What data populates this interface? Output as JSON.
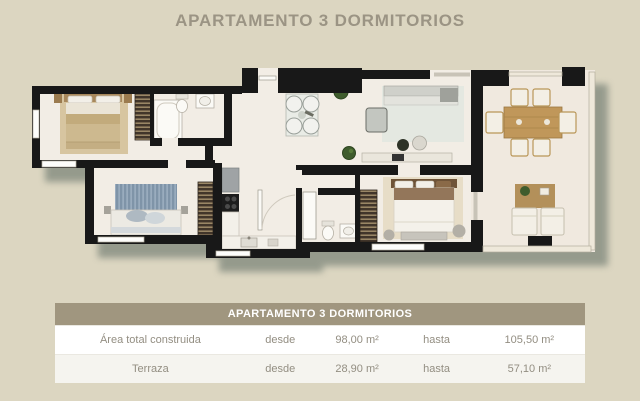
{
  "title": "APARTAMENTO 3 DORMITORIOS",
  "table": {
    "header": "APARTAMENTO 3 DORMITORIOS",
    "rows": [
      {
        "cells": [
          "Área total construida",
          "desde",
          "98,00 m²",
          "hasta",
          "105,50 m²"
        ]
      },
      {
        "cells": [
          "Terraza",
          "desde",
          "28,90 m²",
          "hasta",
          "57,10 m²"
        ]
      }
    ]
  },
  "colors": {
    "page_background": "#dcd6c1",
    "title_text": "#9b9484",
    "table_header_background": "#a0967f",
    "table_header_text": "#ffffff",
    "table_row_text": "#938e82",
    "plan_wall": "#181818",
    "plan_floor": "#f2ede5",
    "plan_terrace_floor": "#f0e9df",
    "plan_shadow": "#848c80"
  }
}
